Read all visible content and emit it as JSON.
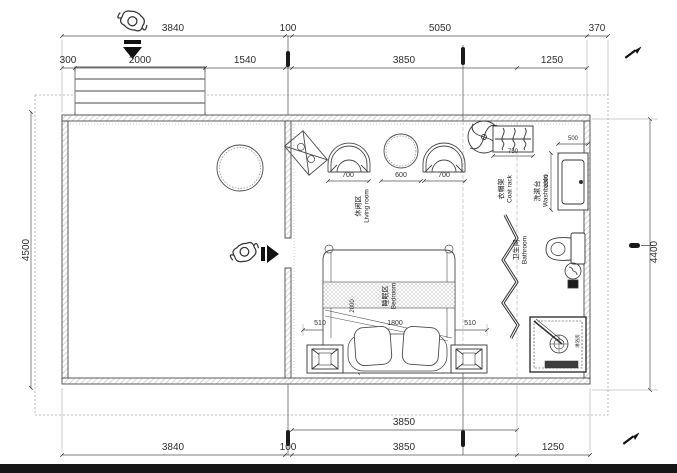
{
  "dims": {
    "top1": [
      "3840",
      "100",
      "5050",
      "370"
    ],
    "top2": [
      "300",
      "2000",
      "1540",
      "3850",
      "1250"
    ],
    "left": "4500",
    "right": "4400",
    "bottom1": "3850",
    "bottom2": [
      "3840",
      "100",
      "3850",
      "1250"
    ],
    "living": [
      "700",
      "600",
      "700"
    ],
    "coat_rack_w": "750",
    "washbasin_w": "500",
    "washbasin_d": "1000",
    "bed": [
      "510",
      "1800",
      "510"
    ],
    "bed_l": "2000"
  },
  "labels": {
    "living": {
      "zh": "休闲区",
      "en": "Living room"
    },
    "bedroom": {
      "zh": "睡眠区",
      "en": "Bedroom"
    },
    "bathroom": {
      "zh": "卫生间",
      "en": "Bathroom"
    },
    "washbasin": {
      "zh": "洗漱台",
      "en": "Washbasin"
    },
    "coat_rack": {
      "zh": "衣帽架",
      "en": "Coat rack"
    },
    "shower": {
      "zh": "淋浴房"
    }
  },
  "colors": {
    "line": "#4a4a4a",
    "dim_line": "#555555",
    "grid": "#777777",
    "dashed": "#aaaaaa",
    "marker_black": "#1a1a1a",
    "background": "#ffffff"
  }
}
